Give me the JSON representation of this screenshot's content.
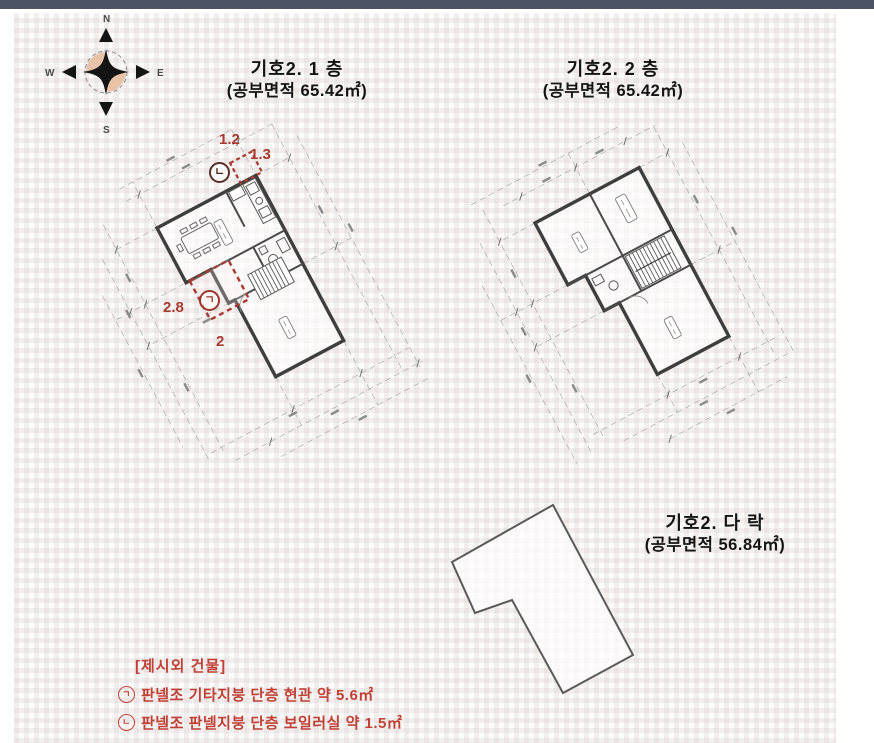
{
  "compass": {
    "n": "N",
    "e": "E",
    "s": "S",
    "w": "W"
  },
  "plans": [
    {
      "id": "floor1",
      "title1": "기호2. 1 층",
      "title2": "(공부면적  65.42㎡)",
      "annotations": {
        "boiler": {
          "w": "1.2",
          "h": "1.3",
          "marker": "ㄴ"
        },
        "porch": {
          "w": "2.8",
          "h": "2",
          "marker": "ㄱ"
        }
      }
    },
    {
      "id": "floor2",
      "title1": "기호2. 2 층",
      "title2": "(공부면적  65.42㎡)"
    },
    {
      "id": "attic",
      "title1": "기호2. 다 락",
      "title2": "(공부면적  56.84㎡)"
    }
  ],
  "footer": {
    "heading": "[제시외 건물]",
    "items": [
      {
        "marker": "ㄱ",
        "text": "판넬조 기타지붕 단층 현관 약 5.6㎡"
      },
      {
        "marker": "ㄴ",
        "text": "판넬조 판넬지붕 단층 보일러실 약 1.5㎡"
      }
    ]
  },
  "colors": {
    "annotation_red": "#a73a30",
    "footer_red": "#bf4136",
    "wall": "#3e3e3e",
    "dimension_line": "#a9a9a9",
    "topbar": "#4b5462",
    "compass_fill": "#e9c3a8"
  }
}
